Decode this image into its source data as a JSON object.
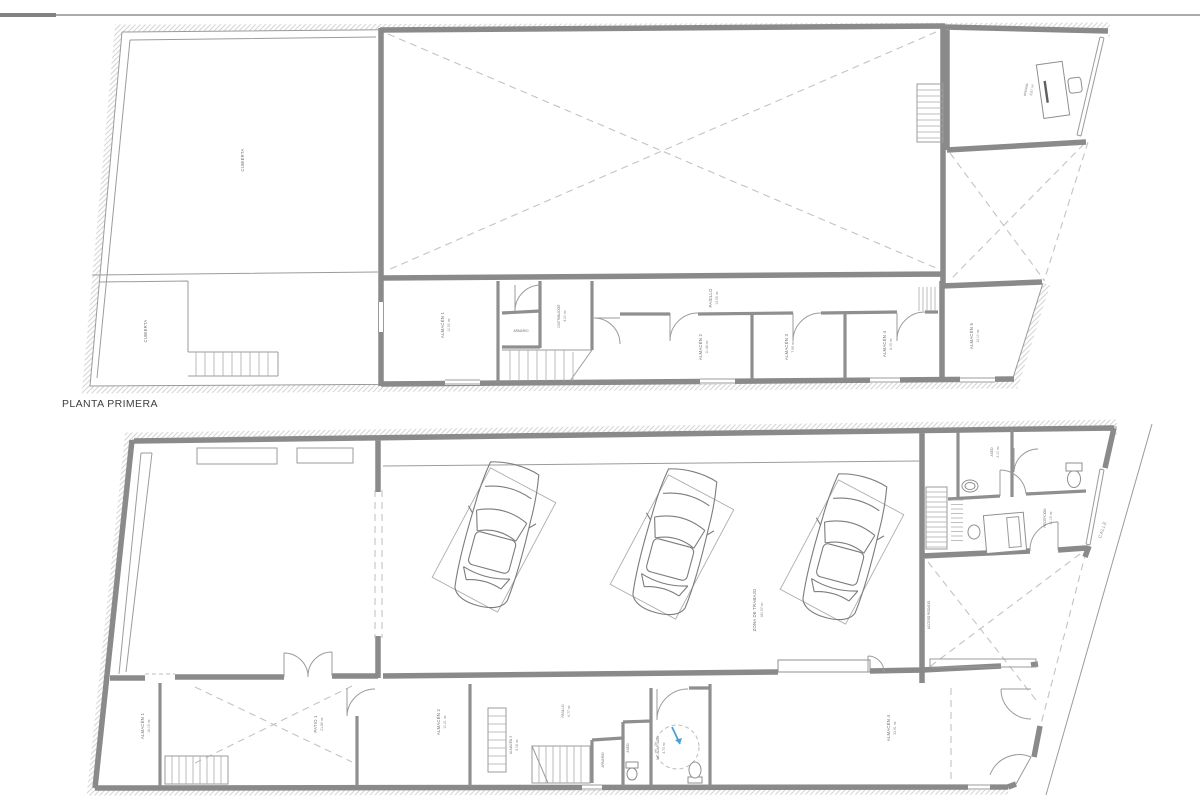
{
  "document": {
    "caption_upper": "PLANTA PRIMERA",
    "street_label": "CALLE",
    "accent_blue": "#4aa0d6",
    "wall_color": "#8a8a8a",
    "line_color": "#9b9b9b"
  },
  "upper": {
    "rooms": [
      {
        "label": "CUBIERTA",
        "area": ""
      },
      {
        "label": "CUBIERTA",
        "area": ""
      },
      {
        "label": "OFICINA",
        "area": "8.87 m²"
      },
      {
        "label": "ALMACÉN 1",
        "area": "10.52 m²"
      },
      {
        "label": "ARMARIO",
        "area": ""
      },
      {
        "label": "DISTRIBUIDOR",
        "area": "4.20 m²"
      },
      {
        "label": "PASILLO",
        "area": "13.55 m²"
      },
      {
        "label": "ALMACÉN 2",
        "area": "11.44 m²"
      },
      {
        "label": "ALMACÉN 3",
        "area": "7.99 m²"
      },
      {
        "label": "ALMACÉN 4",
        "area": "8.05 m²"
      },
      {
        "label": "ALMACÉN 5",
        "area": "12.10 m²"
      }
    ]
  },
  "lower": {
    "rooms": [
      {
        "label": "ZONA DE TRABAJO",
        "area": "180.97 m²"
      },
      {
        "label": "ASEO",
        "area": "3.10 m²"
      },
      {
        "label": "RECEPCIÓN",
        "area": "10.15 m²"
      },
      {
        "label": "ACCESO RODADO",
        "area": ""
      },
      {
        "label": "ALMACÉN 1",
        "area": "16.15 m²"
      },
      {
        "label": "PATIO 1",
        "area": "21.86 m²"
      },
      {
        "label": "ALMACÉN 2",
        "area": "10.21 m²"
      },
      {
        "label": "ALMACÉN 3",
        "area": "9.08 m²"
      },
      {
        "label": "PASILLO",
        "area": "6.77 m²"
      },
      {
        "label": "ARMARIO",
        "area": ""
      },
      {
        "label": "ASEO",
        "area": "2.90 m²"
      },
      {
        "label": "WC ADAPTADO",
        "area": "4.73 m²"
      },
      {
        "label": "ALMACÉN 4",
        "area": "33.91 m²"
      }
    ]
  }
}
